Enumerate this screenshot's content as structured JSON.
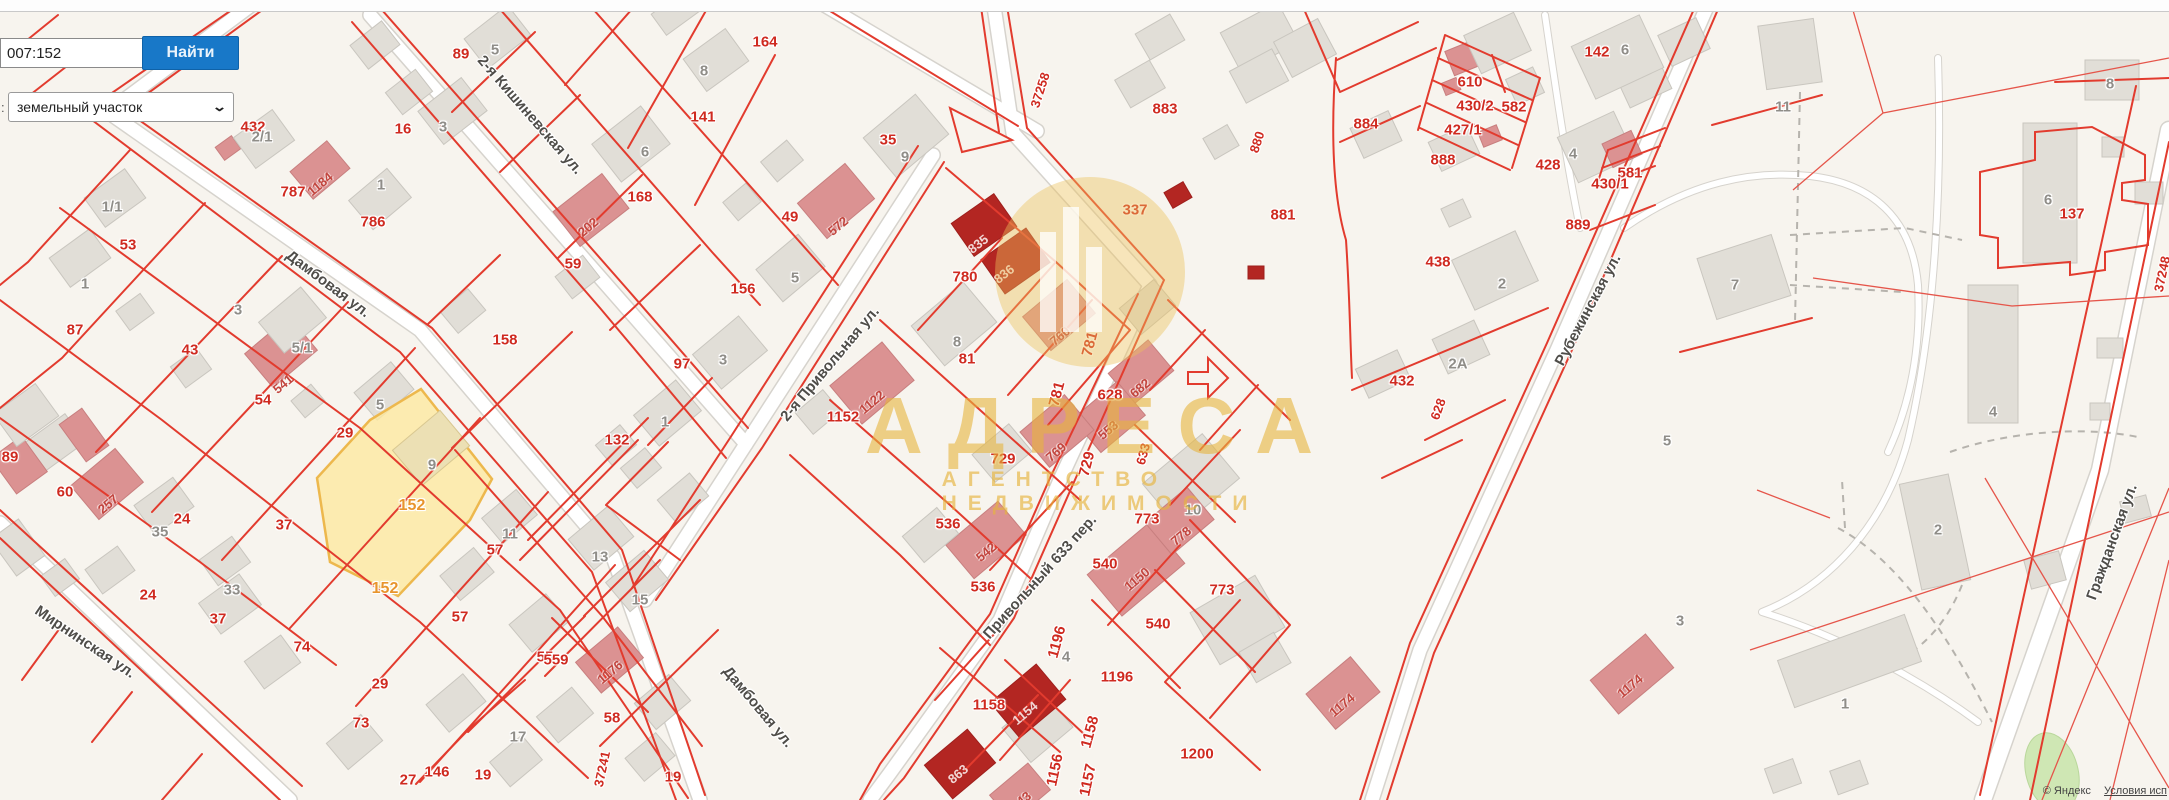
{
  "search": {
    "value": "007:152",
    "button": "Найти",
    "prefix": ":",
    "category": "земельный участок"
  },
  "watermark": {
    "title": "АДРЕСА",
    "subtitle": "АГЕНТСТВО НЕДВИЖИМОСТИ"
  },
  "attribution": {
    "provider": "© Яндекс",
    "terms": "Условия исп"
  },
  "highlight_parcel": {
    "number": "152",
    "fill": "#fce9a0",
    "border": "#edb84d"
  },
  "colors": {
    "parcel_line": "#e23b2e",
    "label_red": "#cf2a20",
    "label_orange": "#e8952d",
    "accent_button": "#1878c8",
    "watermark_gold": "#e6b43e"
  },
  "streets": [
    {
      "t": "Дамбовая ул.",
      "x": 328,
      "y": 272,
      "r": 37
    },
    {
      "t": "Дамбовая ул.",
      "x": 758,
      "y": 695,
      "r": 50
    },
    {
      "t": "2-я Кишиневская ул.",
      "x": 530,
      "y": 103,
      "r": 49
    },
    {
      "t": "Мирнинская ул.",
      "x": 85,
      "y": 630,
      "r": 34
    },
    {
      "t": "2-я Привольная ул.",
      "x": 830,
      "y": 352,
      "r": -50
    },
    {
      "t": "Привольный 633 пер.",
      "x": 1040,
      "y": 565,
      "r": -48
    },
    {
      "t": "Рубежинская ул.",
      "x": 1588,
      "y": 298,
      "r": -62
    },
    {
      "t": "Гражданская ул.",
      "x": 2112,
      "y": 530,
      "r": -70
    }
  ],
  "road_numbers": [
    {
      "t": "37258",
      "x": 1040,
      "y": 78,
      "r": -72
    },
    {
      "t": "880",
      "x": 1257,
      "y": 130,
      "r": -72
    },
    {
      "t": "633",
      "x": 1143,
      "y": 442,
      "r": -75
    },
    {
      "t": "37241",
      "x": 602,
      "y": 757,
      "r": -78
    },
    {
      "t": "628",
      "x": 1438,
      "y": 397,
      "r": -70
    },
    {
      "t": "37248",
      "x": 2162,
      "y": 262,
      "r": -78
    }
  ],
  "labels_red": [
    {
      "t": "432",
      "x": 253,
      "y": 115
    },
    {
      "t": "787",
      "x": 293,
      "y": 180
    },
    {
      "t": "786",
      "x": 373,
      "y": 210
    },
    {
      "t": "16",
      "x": 403,
      "y": 117
    },
    {
      "t": "89",
      "x": 461,
      "y": 42
    },
    {
      "t": "164",
      "x": 765,
      "y": 30
    },
    {
      "t": "141",
      "x": 703,
      "y": 105
    },
    {
      "t": "168",
      "x": 640,
      "y": 185
    },
    {
      "t": "59",
      "x": 573,
      "y": 252
    },
    {
      "t": "158",
      "x": 505,
      "y": 328
    },
    {
      "t": "156",
      "x": 743,
      "y": 277
    },
    {
      "t": "97",
      "x": 682,
      "y": 352
    },
    {
      "t": "132",
      "x": 617,
      "y": 428
    },
    {
      "t": "49",
      "x": 790,
      "y": 205
    },
    {
      "t": "35",
      "x": 888,
      "y": 128
    },
    {
      "t": "53",
      "x": 128,
      "y": 233
    },
    {
      "t": "87",
      "x": 75,
      "y": 318
    },
    {
      "t": "43",
      "x": 190,
      "y": 338
    },
    {
      "t": "54",
      "x": 263,
      "y": 388
    },
    {
      "t": "29",
      "x": 345,
      "y": 421
    },
    {
      "t": "60",
      "x": 65,
      "y": 480
    },
    {
      "t": "24",
      "x": 182,
      "y": 507
    },
    {
      "t": "37",
      "x": 284,
      "y": 513
    },
    {
      "t": "24",
      "x": 148,
      "y": 583
    },
    {
      "t": "37",
      "x": 218,
      "y": 607
    },
    {
      "t": "89",
      "x": 10,
      "y": 445
    },
    {
      "t": "74",
      "x": 302,
      "y": 635
    },
    {
      "t": "29",
      "x": 380,
      "y": 672
    },
    {
      "t": "73",
      "x": 361,
      "y": 711
    },
    {
      "t": "27",
      "x": 408,
      "y": 768
    },
    {
      "t": "146",
      "x": 437,
      "y": 760
    },
    {
      "t": "19",
      "x": 483,
      "y": 763
    },
    {
      "t": "19",
      "x": 673,
      "y": 765
    },
    {
      "t": "58",
      "x": 612,
      "y": 706
    },
    {
      "t": "55",
      "x": 545,
      "y": 645
    },
    {
      "t": "57",
      "x": 460,
      "y": 605
    },
    {
      "t": "57",
      "x": 495,
      "y": 538
    },
    {
      "t": "559",
      "x": 556,
      "y": 648
    },
    {
      "t": "780",
      "x": 965,
      "y": 265
    },
    {
      "t": "81",
      "x": 967,
      "y": 347
    },
    {
      "t": "1152",
      "x": 843,
      "y": 405
    },
    {
      "t": "781",
      "x": 1090,
      "y": 332,
      "r": -75
    },
    {
      "t": "781",
      "x": 1057,
      "y": 382,
      "r": -75
    },
    {
      "t": "628",
      "x": 1110,
      "y": 383
    },
    {
      "t": "729",
      "x": 1003,
      "y": 447
    },
    {
      "t": "729",
      "x": 1087,
      "y": 452,
      "r": -75
    },
    {
      "t": "536",
      "x": 948,
      "y": 512
    },
    {
      "t": "536",
      "x": 983,
      "y": 575
    },
    {
      "t": "773",
      "x": 1147,
      "y": 507
    },
    {
      "t": "773",
      "x": 1222,
      "y": 578
    },
    {
      "t": "540",
      "x": 1105,
      "y": 552
    },
    {
      "t": "540",
      "x": 1158,
      "y": 612
    },
    {
      "t": "1158",
      "x": 989,
      "y": 693
    },
    {
      "t": "1158",
      "x": 1090,
      "y": 720,
      "r": -75
    },
    {
      "t": "1156",
      "x": 1055,
      "y": 758,
      "r": -78
    },
    {
      "t": "1157",
      "x": 1088,
      "y": 768,
      "r": -78
    },
    {
      "t": "1196",
      "x": 1057,
      "y": 630,
      "r": -75
    },
    {
      "t": "1196",
      "x": 1117,
      "y": 665
    },
    {
      "t": "1200",
      "x": 1197,
      "y": 742
    },
    {
      "t": "337",
      "x": 1135,
      "y": 198
    },
    {
      "t": "883",
      "x": 1165,
      "y": 97
    },
    {
      "t": "881",
      "x": 1283,
      "y": 203
    },
    {
      "t": "610",
      "x": 1470,
      "y": 70
    },
    {
      "t": "430/2",
      "x": 1475,
      "y": 94
    },
    {
      "t": "582",
      "x": 1514,
      "y": 95
    },
    {
      "t": "427/1",
      "x": 1463,
      "y": 118
    },
    {
      "t": "888",
      "x": 1443,
      "y": 148
    },
    {
      "t": "884",
      "x": 1366,
      "y": 112
    },
    {
      "t": "428",
      "x": 1548,
      "y": 153
    },
    {
      "t": "581",
      "x": 1630,
      "y": 161
    },
    {
      "t": "430/1",
      "x": 1610,
      "y": 172
    },
    {
      "t": "889",
      "x": 1578,
      "y": 213
    },
    {
      "t": "142",
      "x": 1597,
      "y": 40
    },
    {
      "t": "438",
      "x": 1438,
      "y": 250
    },
    {
      "t": "432",
      "x": 1402,
      "y": 369
    },
    {
      "t": "137",
      "x": 2072,
      "y": 202
    }
  ],
  "labels_orange": [
    {
      "t": "152",
      "x": 412,
      "y": 494
    },
    {
      "t": "152",
      "x": 385,
      "y": 577
    }
  ],
  "labels_gray": [
    {
      "t": "1/1",
      "x": 112,
      "y": 195
    },
    {
      "t": "2/1",
      "x": 262,
      "y": 125
    },
    {
      "t": "5/1",
      "x": 302,
      "y": 336
    },
    {
      "t": "1",
      "x": 85,
      "y": 272
    },
    {
      "t": "3",
      "x": 238,
      "y": 298
    },
    {
      "t": "35",
      "x": 160,
      "y": 520
    },
    {
      "t": "33",
      "x": 232,
      "y": 578
    },
    {
      "t": "5",
      "x": 495,
      "y": 38
    },
    {
      "t": "3",
      "x": 443,
      "y": 115
    },
    {
      "t": "1",
      "x": 381,
      "y": 173
    },
    {
      "t": "5",
      "x": 380,
      "y": 393
    },
    {
      "t": "9",
      "x": 432,
      "y": 453
    },
    {
      "t": "11",
      "x": 510,
      "y": 522
    },
    {
      "t": "13",
      "x": 600,
      "y": 545
    },
    {
      "t": "15",
      "x": 640,
      "y": 588
    },
    {
      "t": "17",
      "x": 518,
      "y": 725
    },
    {
      "t": "6",
      "x": 645,
      "y": 140
    },
    {
      "t": "8",
      "x": 704,
      "y": 59
    },
    {
      "t": "9",
      "x": 905,
      "y": 145
    },
    {
      "t": "3",
      "x": 723,
      "y": 348
    },
    {
      "t": "1",
      "x": 665,
      "y": 410
    },
    {
      "t": "5",
      "x": 795,
      "y": 266
    },
    {
      "t": "8",
      "x": 957,
      "y": 330
    },
    {
      "t": "10",
      "x": 1193,
      "y": 498
    },
    {
      "t": "4",
      "x": 1066,
      "y": 645
    },
    {
      "t": "6",
      "x": 1625,
      "y": 38
    },
    {
      "t": "4",
      "x": 1573,
      "y": 142
    },
    {
      "t": "2",
      "x": 1502,
      "y": 272
    },
    {
      "t": "2А",
      "x": 1458,
      "y": 352
    },
    {
      "t": "11",
      "x": 1783,
      "y": 95
    },
    {
      "t": "7",
      "x": 1735,
      "y": 273
    },
    {
      "t": "8",
      "x": 2110,
      "y": 72
    },
    {
      "t": "6",
      "x": 2048,
      "y": 188
    },
    {
      "t": "4",
      "x": 1993,
      "y": 400
    },
    {
      "t": "2",
      "x": 1938,
      "y": 518
    },
    {
      "t": "1",
      "x": 1845,
      "y": 692
    },
    {
      "t": "5",
      "x": 1667,
      "y": 429
    },
    {
      "t": "3",
      "x": 1680,
      "y": 609
    }
  ],
  "labels_building": [
    {
      "t": "1184",
      "x": 320,
      "y": 172,
      "r": -40
    },
    {
      "t": "202",
      "x": 588,
      "y": 215,
      "r": -40
    },
    {
      "t": "572",
      "x": 838,
      "y": 214,
      "r": -40
    },
    {
      "t": "541",
      "x": 283,
      "y": 372,
      "r": -40
    },
    {
      "t": "257",
      "x": 108,
      "y": 492,
      "r": -40
    },
    {
      "t": "1176",
      "x": 610,
      "y": 660,
      "r": -40
    },
    {
      "t": "1122",
      "x": 872,
      "y": 390,
      "r": -40
    },
    {
      "t": "760",
      "x": 1060,
      "y": 324,
      "r": -40
    },
    {
      "t": "682",
      "x": 1140,
      "y": 376,
      "r": -40
    },
    {
      "t": "553",
      "x": 1108,
      "y": 418,
      "r": -40
    },
    {
      "t": "769",
      "x": 1056,
      "y": 440,
      "r": -40
    },
    {
      "t": "542",
      "x": 986,
      "y": 540,
      "r": -40
    },
    {
      "t": "778",
      "x": 1181,
      "y": 524,
      "r": -40
    },
    {
      "t": "1150",
      "x": 1137,
      "y": 567,
      "r": -40
    },
    {
      "t": "843",
      "x": 1021,
      "y": 789,
      "r": -40
    },
    {
      "t": "1174",
      "x": 1342,
      "y": 693,
      "r": -40
    },
    {
      "t": "1174",
      "x": 1630,
      "y": 674,
      "r": -40
    }
  ],
  "labels_on_dark": [
    {
      "t": "835",
      "x": 978,
      "y": 232,
      "r": -38
    },
    {
      "t": "836",
      "x": 1004,
      "y": 262,
      "r": -38
    },
    {
      "t": "1154",
      "x": 1025,
      "y": 701,
      "r": -40
    },
    {
      "t": "863",
      "x": 958,
      "y": 762,
      "r": -40
    }
  ],
  "buildings": [
    [
      470,
      18,
      55,
      38,
      -38,
      "g"
    ],
    [
      425,
      90,
      55,
      42,
      -38,
      "g"
    ],
    [
      390,
      78,
      38,
      28,
      -38,
      "g"
    ],
    [
      355,
      30,
      40,
      30,
      -38,
      "g"
    ],
    [
      218,
      140,
      20,
      16,
      -36,
      "p"
    ],
    [
      296,
      152,
      48,
      36,
      -40,
      "p"
    ],
    [
      355,
      180,
      50,
      38,
      -40,
      "g"
    ],
    [
      240,
      120,
      48,
      38,
      -36,
      "g"
    ],
    [
      90,
      180,
      50,
      36,
      -36,
      "g"
    ],
    [
      55,
      240,
      50,
      36,
      -36,
      "g"
    ],
    [
      175,
      355,
      32,
      26,
      -36,
      "g"
    ],
    [
      120,
      300,
      30,
      24,
      -36,
      "g"
    ],
    [
      252,
      330,
      58,
      44,
      -40,
      "p"
    ],
    [
      265,
      300,
      55,
      40,
      -40,
      "g"
    ],
    [
      295,
      390,
      26,
      22,
      -40,
      "g"
    ],
    [
      360,
      373,
      48,
      36,
      -40,
      "g"
    ],
    [
      30,
      425,
      50,
      35,
      -36,
      "g"
    ],
    [
      78,
      462,
      58,
      44,
      -40,
      "p"
    ],
    [
      0,
      443,
      38,
      44,
      -36,
      "p"
    ],
    [
      0,
      395,
      52,
      40,
      -36,
      "g"
    ],
    [
      70,
      412,
      28,
      46,
      -36,
      "p"
    ],
    [
      140,
      488,
      48,
      36,
      -36,
      "g"
    ],
    [
      205,
      545,
      40,
      32,
      -36,
      "g"
    ],
    [
      90,
      555,
      40,
      30,
      -36,
      "g"
    ],
    [
      205,
      585,
      50,
      38,
      -36,
      "g"
    ],
    [
      250,
      645,
      45,
      34,
      -36,
      "g"
    ],
    [
      0,
      525,
      35,
      45,
      -36,
      "g"
    ],
    [
      45,
      565,
      30,
      25,
      -36,
      "g"
    ],
    [
      332,
      725,
      45,
      34,
      -40,
      "g"
    ],
    [
      432,
      685,
      48,
      36,
      -40,
      "g"
    ],
    [
      495,
      745,
      42,
      32,
      -40,
      "g"
    ],
    [
      542,
      698,
      46,
      34,
      -40,
      "g"
    ],
    [
      630,
      742,
      40,
      30,
      -40,
      "g"
    ],
    [
      515,
      605,
      48,
      36,
      -40,
      "g"
    ],
    [
      445,
      558,
      44,
      32,
      -40,
      "g"
    ],
    [
      487,
      500,
      45,
      33,
      -40,
      "g"
    ],
    [
      575,
      518,
      52,
      40,
      -40,
      "g"
    ],
    [
      612,
      562,
      50,
      38,
      -40,
      "g"
    ],
    [
      582,
      640,
      55,
      40,
      -40,
      "p"
    ],
    [
      640,
      685,
      45,
      34,
      -40,
      "g"
    ],
    [
      600,
      120,
      62,
      48,
      -38,
      "g"
    ],
    [
      560,
      188,
      62,
      44,
      -38,
      "p"
    ],
    [
      560,
      263,
      35,
      28,
      -38,
      "g"
    ],
    [
      445,
      297,
      36,
      28,
      -40,
      "g"
    ],
    [
      690,
      40,
      52,
      40,
      -36,
      "g"
    ],
    [
      655,
      0,
      40,
      26,
      -36,
      "g"
    ],
    [
      872,
      110,
      68,
      52,
      -40,
      "g"
    ],
    [
      805,
      178,
      62,
      46,
      -40,
      "p"
    ],
    [
      765,
      148,
      34,
      26,
      -40,
      "g"
    ],
    [
      727,
      190,
      30,
      24,
      -40,
      "g"
    ],
    [
      700,
      330,
      60,
      45,
      -40,
      "g"
    ],
    [
      763,
      247,
      55,
      42,
      -40,
      "g"
    ],
    [
      640,
      393,
      55,
      40,
      -40,
      "g"
    ],
    [
      600,
      432,
      32,
      26,
      -40,
      "g"
    ],
    [
      625,
      455,
      32,
      26,
      -40,
      "g"
    ],
    [
      662,
      483,
      42,
      30,
      -40,
      "g"
    ],
    [
      400,
      425,
      62,
      46,
      -40,
      "y"
    ],
    [
      920,
      298,
      68,
      52,
      -40,
      "g"
    ],
    [
      838,
      358,
      68,
      50,
      -40,
      "p"
    ],
    [
      800,
      398,
      36,
      28,
      -40,
      "g"
    ],
    [
      1030,
      293,
      58,
      44,
      -40,
      "p"
    ],
    [
      1125,
      290,
      45,
      34,
      -40,
      "g"
    ],
    [
      1115,
      352,
      52,
      40,
      -40,
      "p"
    ],
    [
      1080,
      395,
      58,
      44,
      -40,
      "p"
    ],
    [
      1028,
      408,
      58,
      46,
      -40,
      "p"
    ],
    [
      978,
      435,
      48,
      36,
      -40,
      "g"
    ],
    [
      958,
      205,
      52,
      40,
      -35,
      "d"
    ],
    [
      988,
      240,
      55,
      42,
      -35,
      "d"
    ],
    [
      1095,
      542,
      82,
      54,
      -40,
      "p"
    ],
    [
      1152,
      452,
      78,
      58,
      -40,
      "g"
    ],
    [
      1152,
      500,
      55,
      42,
      -40,
      "p"
    ],
    [
      952,
      518,
      68,
      44,
      -40,
      "p"
    ],
    [
      908,
      518,
      45,
      34,
      -40,
      "g"
    ],
    [
      1010,
      705,
      55,
      45,
      -40,
      "g"
    ],
    [
      998,
      678,
      60,
      46,
      -40,
      "d"
    ],
    [
      932,
      742,
      56,
      44,
      -40,
      "d"
    ],
    [
      995,
      775,
      50,
      35,
      -40,
      "p"
    ],
    [
      1200,
      590,
      75,
      60,
      -30,
      "g"
    ],
    [
      1245,
      640,
      40,
      35,
      -30,
      "g"
    ],
    [
      1207,
      130,
      28,
      24,
      -30,
      "g"
    ],
    [
      1140,
      22,
      40,
      30,
      -30,
      "g"
    ],
    [
      1120,
      68,
      40,
      32,
      -30,
      "g"
    ],
    [
      1167,
      186,
      22,
      18,
      -30,
      "d"
    ],
    [
      1248,
      266,
      16,
      13,
      0,
      "d"
    ],
    [
      1227,
      15,
      65,
      45,
      -28,
      "g"
    ],
    [
      1280,
      28,
      50,
      40,
      -28,
      "g"
    ],
    [
      1235,
      58,
      48,
      36,
      -28,
      "g"
    ],
    [
      1448,
      42,
      46,
      26,
      -22,
      "p"
    ],
    [
      1443,
      80,
      16,
      13,
      -22,
      "p"
    ],
    [
      1480,
      128,
      20,
      16,
      -22,
      "p"
    ],
    [
      1470,
      22,
      55,
      42,
      -25,
      "g"
    ],
    [
      1510,
      72,
      30,
      28,
      -25,
      "g"
    ],
    [
      1620,
      62,
      46,
      38,
      -25,
      "g"
    ],
    [
      1663,
      25,
      42,
      34,
      -25,
      "g"
    ],
    [
      1433,
      132,
      42,
      32,
      -25,
      "g"
    ],
    [
      1444,
      203,
      24,
      20,
      -25,
      "g"
    ],
    [
      1565,
      122,
      62,
      50,
      -25,
      "g"
    ],
    [
      1606,
      136,
      32,
      26,
      -25,
      "p"
    ],
    [
      1580,
      28,
      75,
      58,
      -25,
      "g"
    ],
    [
      1355,
      118,
      42,
      33,
      -25,
      "g"
    ],
    [
      1460,
      243,
      70,
      55,
      -25,
      "g"
    ],
    [
      1438,
      328,
      46,
      38,
      -25,
      "g"
    ],
    [
      1360,
      358,
      46,
      32,
      -25,
      "g"
    ],
    [
      1705,
      245,
      78,
      64,
      -18,
      "g"
    ],
    [
      1762,
      22,
      56,
      64,
      -8,
      "g"
    ],
    [
      2085,
      60,
      54,
      40,
      0,
      "g"
    ],
    [
      2023,
      123,
      54,
      140,
      0,
      "g"
    ],
    [
      2102,
      137,
      22,
      20,
      0,
      "g"
    ],
    [
      2135,
      182,
      28,
      22,
      0,
      "g"
    ],
    [
      1968,
      285,
      50,
      138,
      0,
      "g"
    ],
    [
      2097,
      338,
      26,
      20,
      0,
      "g"
    ],
    [
      2090,
      403,
      20,
      17,
      0,
      "g"
    ],
    [
      1910,
      478,
      50,
      108,
      -12,
      "g"
    ],
    [
      1782,
      636,
      135,
      50,
      -20,
      "g"
    ],
    [
      1768,
      763,
      30,
      26,
      -20,
      "g"
    ],
    [
      1833,
      765,
      32,
      25,
      -20,
      "g"
    ],
    [
      2027,
      555,
      36,
      30,
      -15,
      "g"
    ],
    [
      2122,
      498,
      27,
      22,
      -15,
      "g"
    ],
    [
      1596,
      652,
      72,
      44,
      -40,
      "p"
    ],
    [
      1314,
      670,
      58,
      46,
      -40,
      "p"
    ]
  ]
}
